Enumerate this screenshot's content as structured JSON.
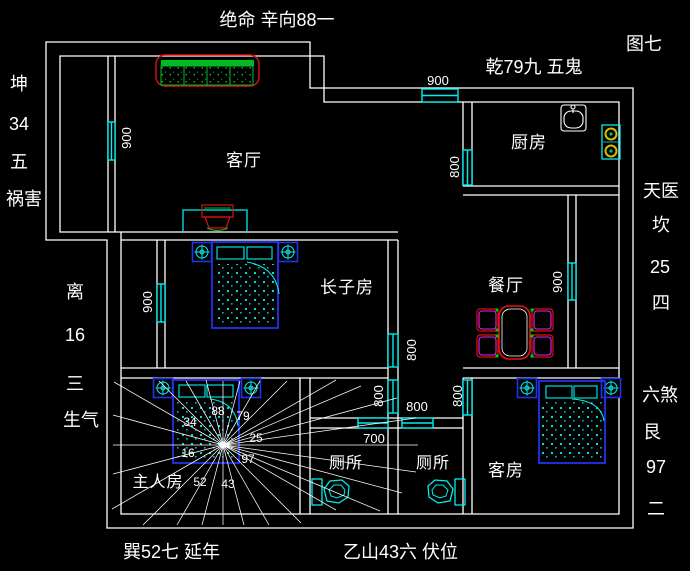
{
  "annotations": {
    "top": "绝命 辛向88一",
    "figure_label": "图七",
    "northwest": "乾79九 五鬼",
    "kun": [
      "坤",
      "34",
      "五",
      "祸害"
    ],
    "li": [
      "离",
      "16",
      "三",
      "生气"
    ],
    "tianyi": [
      "天医",
      "坎",
      "25",
      "四"
    ],
    "liusha": [
      "六煞",
      "艮",
      "97",
      "二"
    ],
    "bottom_left": "巽52七  延年",
    "bottom_right": "乙山43六  伏位"
  },
  "rooms": {
    "living": "客厅",
    "kitchen": "厨房",
    "eldest_son": "长子房",
    "dining": "餐厅",
    "master": "主人房",
    "toilet_1": "厕所",
    "toilet_2": "厕所",
    "guest": "客房"
  },
  "dimensions": {
    "living_west_window": "900",
    "top_window": "900",
    "kitchen_west_window": "800",
    "son_west_window": "900",
    "dining_east_window": "900",
    "hall_upper_window": "800",
    "toilet1_window_left": "800",
    "hall_width": "800",
    "guest_west_window": "800",
    "toilet1_width": "700"
  },
  "compass_numbers": {
    "kun": "34",
    "xin": "88",
    "qian": "79",
    "kan": "25",
    "li": "16",
    "gen": "97",
    "xun": "52",
    "yi": "43"
  },
  "colors": {
    "background": "#000000",
    "walls": "#ffffff",
    "windows": "#00eeee",
    "furniture_blue": "#2233ee",
    "accent_green": "#00cc33",
    "accent_red": "#dd1111",
    "accent_magenta": "#ee22ee",
    "burner_yellow": "#ddbb00"
  }
}
